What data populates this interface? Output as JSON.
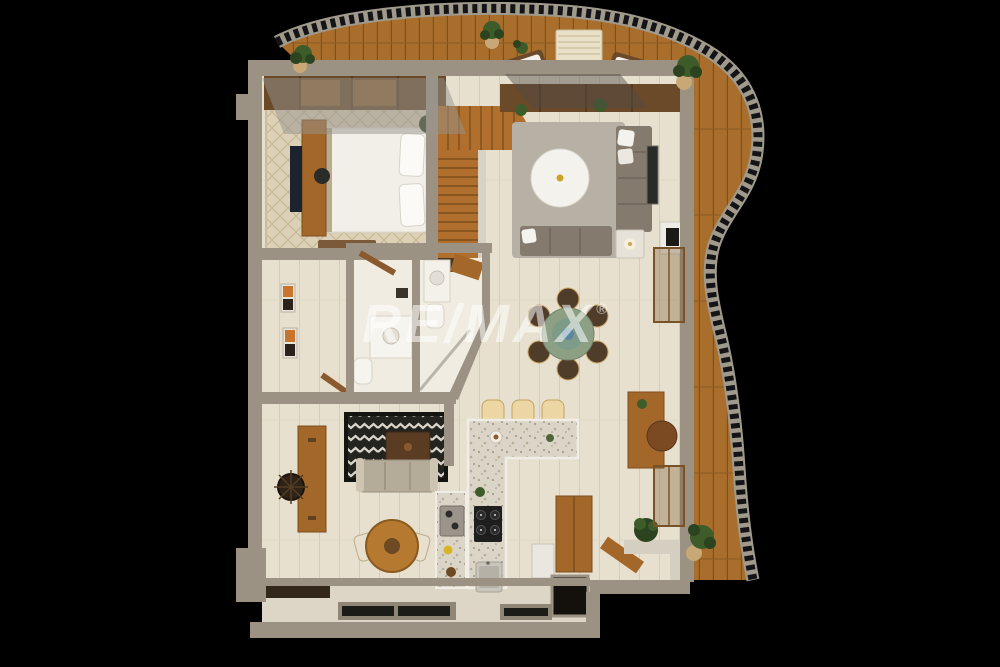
{
  "watermark": {
    "brand": "RE/MAX",
    "registered": "®"
  },
  "palette": {
    "bg": "#000000",
    "deck_wood": "#a96e2c",
    "deck_plank_line": "#7e501c",
    "railing_slat": "#141417",
    "railing_rail": "#a09a8c",
    "wall": "#9c9284",
    "wall_light": "#b3aa9a",
    "floor": "#e7e0ce",
    "tile": "#f0ece1",
    "balcony_floor": "#ddd6c6",
    "rug_beige": "#dcd1b6",
    "rug_gray": "#b7b1a5",
    "rug_black": "#23231f",
    "rug_zigzag": "#d9d5c9",
    "wood_mid": "#a4672a",
    "wood_cabinet": "#6b4a2a",
    "stair_wood": "#b06f2c",
    "sofa_gray": "#847a6e",
    "sofa_beige": "#b5ab99",
    "white_furn": "#f4f2ec",
    "counter_terrazzo": "#dad5c7",
    "stool_cream": "#ecd7a4",
    "table_sage": "#8da083",
    "chair_brown": "#4f3d2a",
    "stove_black": "#1e1e1e",
    "plant_green": "#3e5b2a",
    "plant_dark": "#2c431f",
    "pot_tan": "#c9a877",
    "glass": "rgba(150,148,142,0.5)",
    "watermark": "rgba(255,255,255,0.55)"
  }
}
